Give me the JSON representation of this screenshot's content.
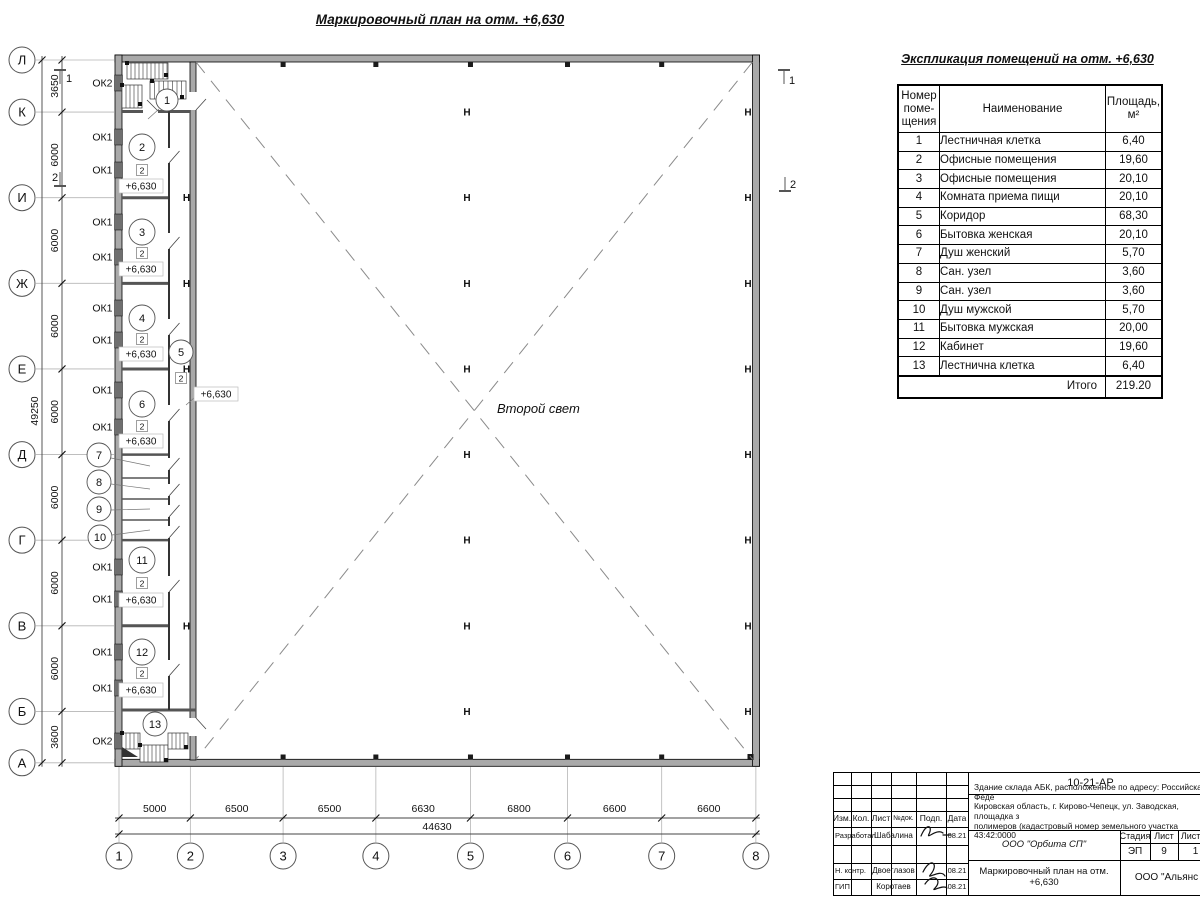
{
  "sheet": {
    "plan_title": "Маркировочный план на отм. +6,630",
    "second_light": "Второй свет",
    "elevation": "+6,630",
    "type_badge": "2",
    "column_glyph": "Н"
  },
  "grid": {
    "row_labels": [
      "Л",
      "К",
      "И",
      "Ж",
      "Е",
      "Д",
      "Г",
      "В",
      "Б",
      "А"
    ],
    "row_spacings": [
      "3650",
      "6000",
      "6000",
      "6000",
      "6000",
      "6000",
      "6000",
      "6000",
      "3600"
    ],
    "row_total": "49250",
    "col_labels": [
      "1",
      "2",
      "3",
      "4",
      "5",
      "6",
      "7",
      "8"
    ],
    "col_spacings": [
      "5000",
      "6500",
      "6500",
      "6630",
      "6800",
      "6600",
      "6600"
    ],
    "col_total": "44630",
    "section_marks": [
      "1",
      "2"
    ]
  },
  "windows": [
    {
      "label": "ОК2",
      "y": 83
    },
    {
      "label": "ОК1",
      "y": 137
    },
    {
      "label": "ОК1",
      "y": 170
    },
    {
      "label": "ОК1",
      "y": 222
    },
    {
      "label": "ОК1",
      "y": 257
    },
    {
      "label": "ОК1",
      "y": 308
    },
    {
      "label": "ОК1",
      "y": 340
    },
    {
      "label": "ОК1",
      "y": 390
    },
    {
      "label": "ОК1",
      "y": 427
    },
    {
      "label": "ОК1",
      "y": 567
    },
    {
      "label": "ОК1",
      "y": 599
    },
    {
      "label": "ОК1",
      "y": 652
    },
    {
      "label": "ОК1",
      "y": 688
    },
    {
      "label": "ОК2",
      "y": 741
    }
  ],
  "rooms": [
    {
      "num": "1",
      "cx": 167,
      "cy": 100,
      "r": 11,
      "leader": [
        159,
        109,
        148,
        119
      ]
    },
    {
      "num": "2",
      "cx": 142,
      "cy": 147,
      "r": 13,
      "sq": [
        142,
        170
      ],
      "elev": [
        141,
        186
      ]
    },
    {
      "num": "3",
      "cx": 142,
      "cy": 232,
      "r": 13,
      "sq": [
        142,
        253
      ],
      "elev": [
        141,
        269
      ]
    },
    {
      "num": "4",
      "cx": 142,
      "cy": 318,
      "r": 13,
      "sq": [
        142,
        339
      ],
      "elev": [
        141,
        354
      ]
    },
    {
      "num": "5",
      "cx": 181,
      "cy": 352,
      "r": 12,
      "sq": [
        181,
        378
      ],
      "elev": [
        216,
        394
      ],
      "leader": [
        194,
        398,
        186,
        405
      ]
    },
    {
      "num": "6",
      "cx": 142,
      "cy": 404,
      "r": 13,
      "sq": [
        142,
        426
      ],
      "elev": [
        141,
        441
      ]
    },
    {
      "num": "7",
      "cx": 99,
      "cy": 455,
      "r": 12,
      "leader": [
        111,
        458,
        150,
        466
      ]
    },
    {
      "num": "8",
      "cx": 99,
      "cy": 482,
      "r": 12,
      "leader": [
        111,
        484,
        150,
        489
      ]
    },
    {
      "num": "9",
      "cx": 99,
      "cy": 509,
      "r": 12,
      "leader": [
        111,
        510,
        150,
        509
      ]
    },
    {
      "num": "10",
      "cx": 100,
      "cy": 537,
      "r": 12,
      "leader": [
        112,
        535,
        150,
        530
      ]
    },
    {
      "num": "11",
      "cx": 142,
      "cy": 560,
      "r": 13,
      "sq": [
        142,
        583
      ],
      "elev": [
        141,
        600
      ]
    },
    {
      "num": "12",
      "cx": 142,
      "cy": 652,
      "r": 13,
      "sq": [
        142,
        673
      ],
      "elev": [
        141,
        690
      ]
    },
    {
      "num": "13",
      "cx": 155,
      "cy": 724,
      "r": 12
    }
  ],
  "explication": {
    "title": "Экспликация помещений на отм. +6,630",
    "header_number": [
      "Номер",
      "поме-",
      "щения"
    ],
    "header_name": "Наименование",
    "header_area": [
      "Площадь,",
      "м²"
    ],
    "rows": [
      [
        "1",
        "Лестничная клетка",
        "6,40"
      ],
      [
        "2",
        "Офисные помещения",
        "19,60"
      ],
      [
        "3",
        "Офисные помещения",
        "20,10"
      ],
      [
        "4",
        "Комната приема пищи",
        "20,10"
      ],
      [
        "5",
        "Коридор",
        "68,30"
      ],
      [
        "6",
        "Бытовка женская",
        "20,10"
      ],
      [
        "7",
        "Душ женский",
        "5,70"
      ],
      [
        "8",
        "Сан. узел",
        "3,60"
      ],
      [
        "9",
        "Сан. узел",
        "3,60"
      ],
      [
        "10",
        "Душ мужской",
        "5,70"
      ],
      [
        "11",
        "Бытовка мужская",
        "20,00"
      ],
      [
        "12",
        "Кабинет",
        "19,60"
      ],
      [
        "13",
        "Лестнична клетка",
        "6,40"
      ]
    ],
    "total_label": "Итого",
    "total_value": "219.20"
  },
  "title_block": {
    "doc_number": "10-21-АР",
    "address": [
      "Здание склада АБК, расположенное по адресу: Российская Феде",
      "Кировская область, г. Кирово-Чепецк, ул. Заводская, площадка з",
      "полимеров (кадастровый номер земельного участка 43:42:0000"
    ],
    "header_cells": [
      "Изм.",
      "Кол.",
      "Лист",
      "№док.",
      "Подп.",
      "Дата"
    ],
    "sign_rows": [
      {
        "role": "Разработал",
        "name": "Шабалина",
        "date": "08.21"
      },
      {
        "role": "Н. контр.",
        "name": "Двоеглазов",
        "date": "08.21"
      },
      {
        "role": "ГИП",
        "name": "Коротаев",
        "date": "08.21"
      }
    ],
    "org": "ООО \"Орбита СП\"",
    "stage_headers": [
      "Стадия",
      "Лист",
      "Листов"
    ],
    "stage_values": [
      "ЭП",
      "9",
      "1"
    ],
    "drawing_title": [
      "Маркировочный план на отм.",
      "+6,630"
    ],
    "org_right": "ООО \"Альянс"
  }
}
